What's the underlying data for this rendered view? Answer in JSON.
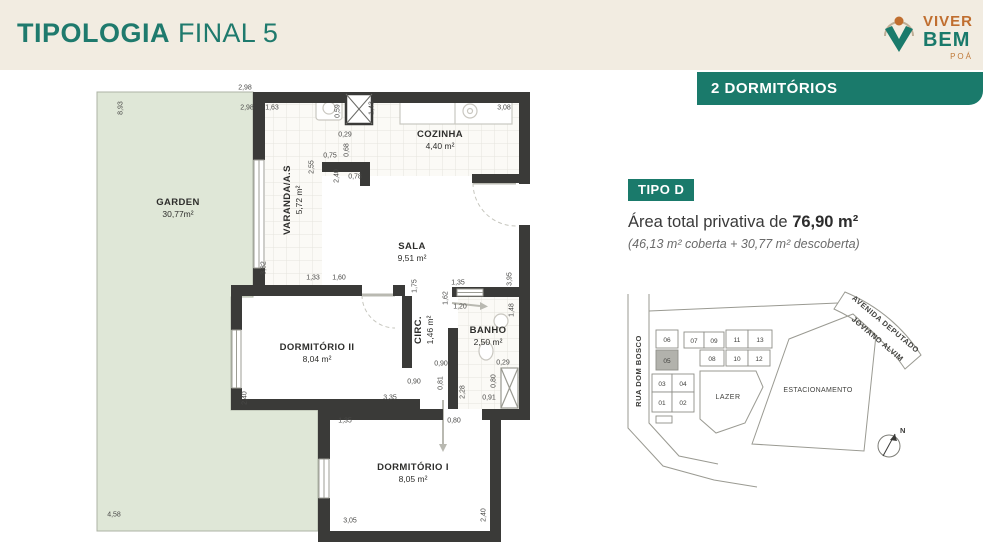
{
  "colors": {
    "teal": "#1a7a6b",
    "orange": "#c06e2f",
    "header_bg": "#f2ece1",
    "garden": "#dfe7d7",
    "wall": "#3a3a38"
  },
  "header": {
    "title_bold": "TIPOLOGIA",
    "title_rest": "FINAL 5"
  },
  "logo": {
    "line1": "VIVER",
    "line2": "BEM",
    "line3": "POÁ"
  },
  "badge": {
    "label": "2 DORMITÓRIOS"
  },
  "info": {
    "tipo": "TIPO D",
    "area_prefix": "Área total privativa de",
    "area_value": "76,90 m²",
    "area_detail": "(46,13  m² coberta + 30,77 m² descoberta)"
  },
  "plan": {
    "rooms": [
      {
        "name": "GARDEN",
        "value": "30,77m²",
        "x": 178,
        "y": 208
      },
      {
        "name": "VARANDA/A.S",
        "value": "5,72 m²",
        "x": 293,
        "y": 200,
        "v": 1
      },
      {
        "name": "COZINHA",
        "value": "4,40 m²",
        "x": 440,
        "y": 140
      },
      {
        "name": "SALA",
        "value": "9,51 m²",
        "x": 412,
        "y": 252
      },
      {
        "name": "DORMITÓRIO II",
        "value": "8,04 m²",
        "x": 317,
        "y": 353
      },
      {
        "name": "CIRC.",
        "value": "1,46 m²",
        "x": 424,
        "y": 330,
        "v": 1
      },
      {
        "name": "BANHO",
        "value": "2,50 m²",
        "x": 488,
        "y": 336
      },
      {
        "name": "DORMITÓRIO I",
        "value": "8,05 m²",
        "x": 413,
        "y": 473
      }
    ],
    "dims": [
      {
        "t": "2,98",
        "x": 245,
        "y": 88
      },
      {
        "t": "8,93",
        "x": 121,
        "y": 108,
        "v": 1
      },
      {
        "t": "2,98",
        "x": 247,
        "y": 108
      },
      {
        "t": "1,63",
        "x": 272,
        "y": 108
      },
      {
        "t": "0,59",
        "x": 338,
        "y": 111,
        "v": 1
      },
      {
        "t": "1,43",
        "x": 372,
        "y": 108,
        "v": 1
      },
      {
        "t": "3,08",
        "x": 504,
        "y": 108
      },
      {
        "t": "0,29",
        "x": 345,
        "y": 135
      },
      {
        "t": "0,68",
        "x": 347,
        "y": 150,
        "v": 1
      },
      {
        "t": "0,75",
        "x": 330,
        "y": 156
      },
      {
        "t": "2,55",
        "x": 312,
        "y": 167,
        "v": 1
      },
      {
        "t": "2,40",
        "x": 337,
        "y": 176,
        "v": 1
      },
      {
        "t": "0,78",
        "x": 355,
        "y": 177
      },
      {
        "t": "3,82",
        "x": 264,
        "y": 268,
        "v": 1
      },
      {
        "t": "1,33",
        "x": 313,
        "y": 278
      },
      {
        "t": "1,60",
        "x": 339,
        "y": 278
      },
      {
        "t": "1,75",
        "x": 415,
        "y": 286,
        "v": 1
      },
      {
        "t": "1,35",
        "x": 458,
        "y": 283
      },
      {
        "t": "3,95",
        "x": 510,
        "y": 279,
        "v": 1
      },
      {
        "t": "1,62",
        "x": 446,
        "y": 298,
        "v": 1
      },
      {
        "t": "1,20",
        "x": 460,
        "y": 307
      },
      {
        "t": "1,48",
        "x": 512,
        "y": 310,
        "v": 1
      },
      {
        "t": "0,90",
        "x": 414,
        "y": 382
      },
      {
        "t": "0,90",
        "x": 441,
        "y": 364
      },
      {
        "t": "0,81",
        "x": 441,
        "y": 383,
        "v": 1
      },
      {
        "t": "0,29",
        "x": 503,
        "y": 363
      },
      {
        "t": "0,80",
        "x": 494,
        "y": 381,
        "v": 1
      },
      {
        "t": "2,28",
        "x": 463,
        "y": 392,
        "v": 1
      },
      {
        "t": "0,91",
        "x": 489,
        "y": 398
      },
      {
        "t": "2,40",
        "x": 245,
        "y": 398,
        "v": 1
      },
      {
        "t": "3,35",
        "x": 390,
        "y": 398
      },
      {
        "t": "1,35",
        "x": 345,
        "y": 421
      },
      {
        "t": "0,80",
        "x": 454,
        "y": 421
      },
      {
        "t": "3,05",
        "x": 350,
        "y": 521
      },
      {
        "t": "2,40",
        "x": 484,
        "y": 515,
        "v": 1
      },
      {
        "t": "4,58",
        "x": 114,
        "y": 515
      }
    ]
  },
  "sitemap": {
    "street_left": "RUA DOM BOSCO",
    "avenue_line1": "AVENIDA DEPUTADO",
    "avenue_line2": "JOVIANO ALVIM",
    "lazer": "LAZER",
    "estacionamento": "ESTACIONAMENTO",
    "north": "N",
    "units": [
      "06",
      "07",
      "09",
      "11",
      "13",
      "05",
      "08",
      "10",
      "12",
      "03",
      "04",
      "01",
      "02"
    ]
  }
}
